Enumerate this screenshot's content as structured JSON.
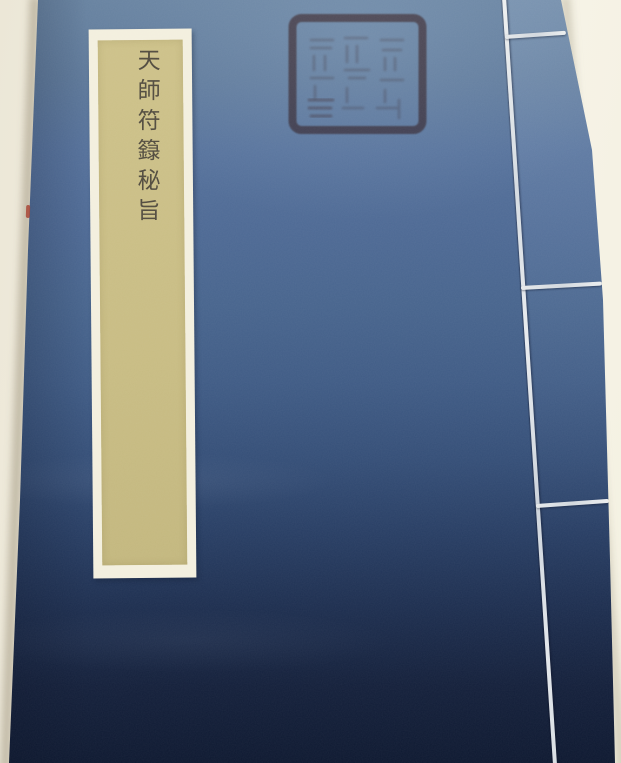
{
  "photo": {
    "description": "Photograph of a traditional Chinese thread-bound (stab-stitched) book with an indigo-blue cover lying on a cream surface",
    "surface_color": "#f4f0e1"
  },
  "cover": {
    "type": "indigo paper-cloth cover, thread binding along the right edge",
    "color_top": "#64809f",
    "color_bottom": "#0d1830"
  },
  "title_label": {
    "text": "天師符籙秘旨",
    "characters": [
      "天",
      "師",
      "符",
      "籙",
      "秘",
      "旨"
    ],
    "writing": "vertical handwritten brush calligraphy",
    "label_color": "#c9bd85",
    "mount_color": "#f3efde",
    "ink_color": "#474238"
  },
  "seal": {
    "shape": "square with rounded corners",
    "ink_color": "#8a4a43",
    "text_legibility": "faded, illegible seal-script characters"
  },
  "binding": {
    "thread_color": "#dde2e6",
    "vertical_thread_count": 1,
    "horizontal_stitch_count": 3
  }
}
